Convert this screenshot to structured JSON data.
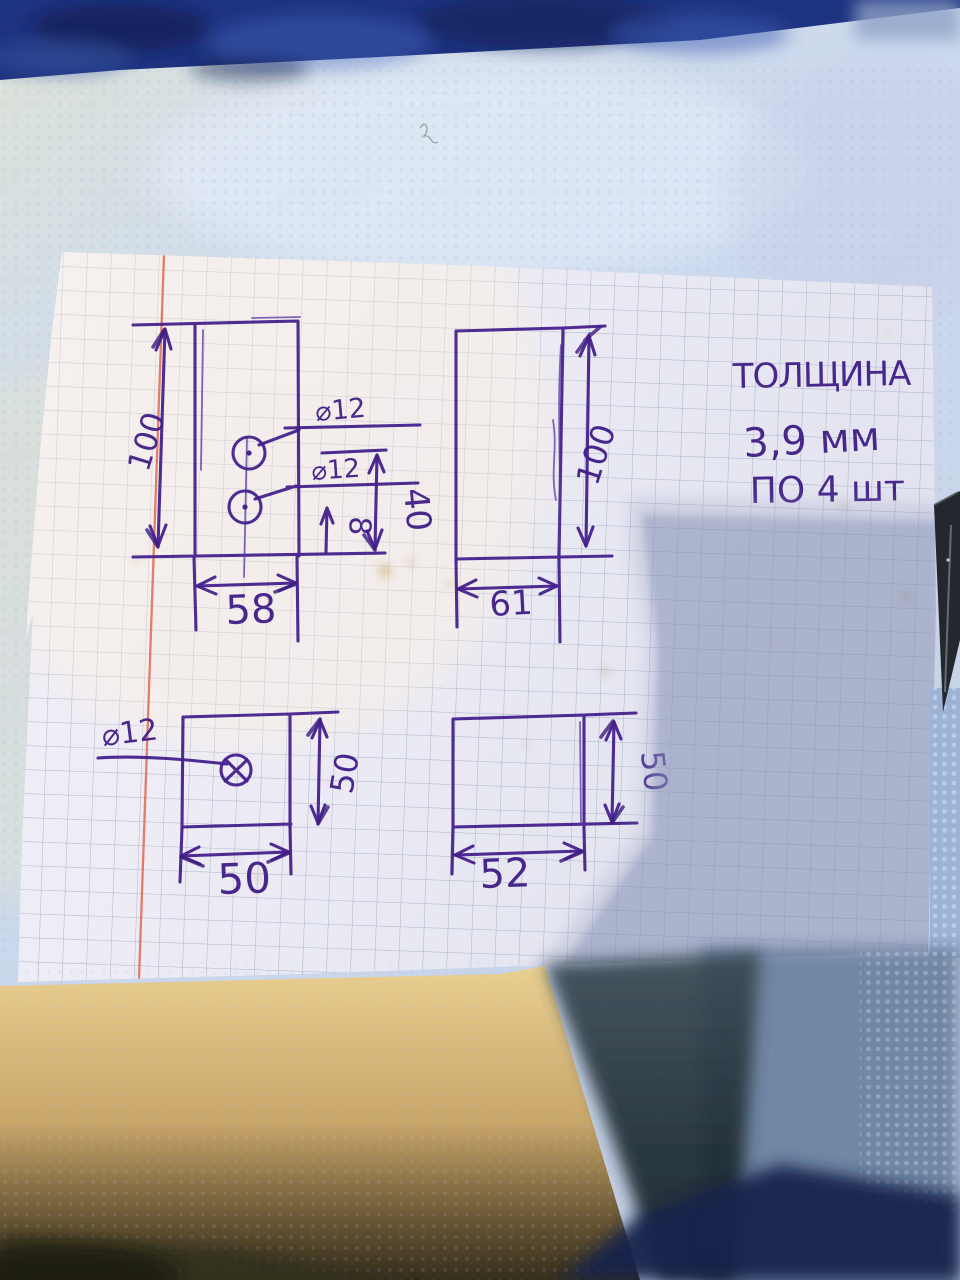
{
  "note": {
    "title": "ТОЛЩИНА",
    "thickness": "3,9 мм",
    "quantity": "ПО 4 шт"
  },
  "parts": {
    "p1": {
      "height": "100",
      "width": "58",
      "hole1": "⌀12",
      "hole2": "⌀12",
      "hole_offset": "40",
      "hole_edge": "8"
    },
    "p2": {
      "height": "100",
      "width": "61"
    },
    "p3": {
      "height": "50",
      "width": "50",
      "hole": "⌀12"
    },
    "p4": {
      "height": "50",
      "width": "52"
    }
  },
  "colors": {
    "ink": "#401d86",
    "paper": "#edebf5",
    "grid_line": "#8c9bb8",
    "margin_line": "#dd6148",
    "fabric": "#1e3380",
    "table": "#ccd9ee",
    "shadow": "#7e89ae"
  }
}
